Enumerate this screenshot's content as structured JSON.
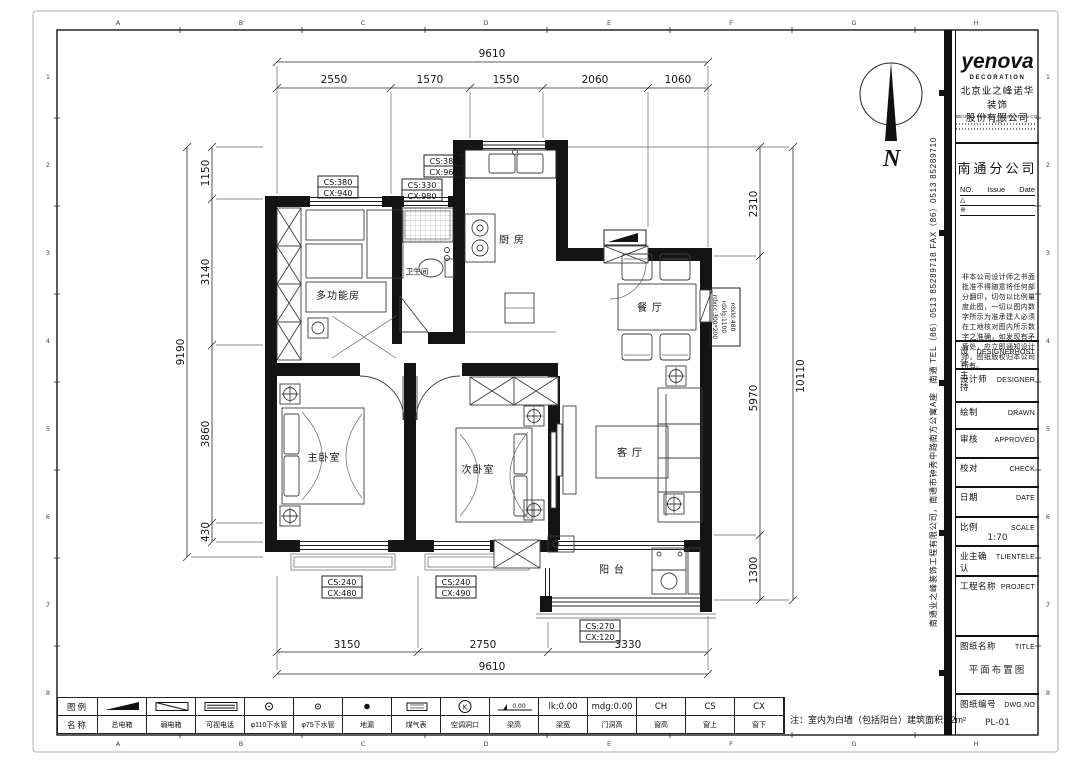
{
  "frame": {
    "letters": [
      "A",
      "B",
      "C",
      "D",
      "E",
      "F",
      "G",
      "H"
    ],
    "numbers": [
      "1",
      "2",
      "3",
      "4",
      "5",
      "6",
      "7",
      "8"
    ]
  },
  "compass": {
    "label": "N"
  },
  "plan": {
    "rooms": {
      "multi": "多功能房",
      "bath": "卫生间",
      "kitchen": "厨 房",
      "dining": "餐 厅",
      "master": "主卧室",
      "second": "次卧室",
      "living": "客 厅",
      "balcony": "阳 台"
    },
    "window_tags": [
      {
        "cs": "CS:380",
        "cx": "CX:940"
      },
      {
        "cs": "CS:330",
        "cx": "CX:980"
      },
      {
        "cs": "CS:380",
        "cx": "CX:960"
      },
      {
        "cs": "CS:240",
        "cx": "CX:480"
      },
      {
        "cs": "CS:240",
        "cx": "CX:490"
      },
      {
        "cs": "CS:270",
        "cx": "CX:120"
      }
    ],
    "beam_tag": {
      "l1": "rdxld:480",
      "l2": "rdxlg:1100",
      "l3": "rdxcc:300*200"
    },
    "dims": {
      "top": {
        "overall": "9610",
        "segs": [
          "2550",
          "1570",
          "1550",
          "2060",
          "1060"
        ]
      },
      "bottom": {
        "overall": "9610",
        "segs": [
          "3150",
          "2750",
          "3330"
        ]
      },
      "left": {
        "overall": "9190",
        "segs": [
          "1150",
          "3140",
          "3860",
          "430"
        ]
      },
      "right": {
        "overall": "10110",
        "segs": [
          "2310",
          "5970",
          "1300"
        ]
      }
    }
  },
  "legend": {
    "row1_header": "图例",
    "row2_header": "名称",
    "items": [
      {
        "name": "总电箱"
      },
      {
        "name": "弱电箱"
      },
      {
        "name": "可视电话"
      },
      {
        "name": "φ110下水管"
      },
      {
        "name": "φ75下水管"
      },
      {
        "name": "地漏"
      },
      {
        "name": "煤气表"
      },
      {
        "name": "空调洞口",
        "symbol_text": "K"
      },
      {
        "name": "梁高",
        "symbol_text": "0.00"
      },
      {
        "name": "梁宽",
        "symbol_text": "lk:0.00"
      },
      {
        "name": "门洞高",
        "symbol_text": "mdg:0.00"
      },
      {
        "name": "窗高",
        "symbol_text": "CH"
      },
      {
        "name": "窗上",
        "symbol_text": "CS"
      },
      {
        "name": "窗下",
        "symbol_text": "CX"
      }
    ],
    "note": "注：室内为白墙（包括阳台）建筑面积:82m²"
  },
  "titleblock": {
    "logo": "yenova",
    "logo_sub": "DECORATION",
    "company_cn1": "北京业之峰诺华装饰",
    "company_cn2": "股份有限公司",
    "company_en": "BEIJING YENOVA DECORATION CO. LTD",
    "branch": "南通分公司",
    "rev": {
      "no": "NO.",
      "issue": "Issue",
      "date": "Date",
      "r1": "△",
      "r2": "※"
    },
    "disclaimer": "非本公司设计师之书面批准不得随意将任何部分翻印，切勿以比例量度此图，一切以图内数字所示为准承建人必须在工地核对图内所示数字之准确，如发现有矛盾处，应立即通知设计师，图纸版权归本公司所有。",
    "rows": [
      {
        "cn": "设计主持",
        "en": "DESIGNERHOST"
      },
      {
        "cn": "设计师",
        "en": "DESIGNER"
      },
      {
        "cn": "绘制",
        "en": "DRAWN"
      },
      {
        "cn": "审核",
        "en": "APPROVED"
      },
      {
        "cn": "校对",
        "en": "CHECK"
      },
      {
        "cn": "日期",
        "en": "DATE"
      },
      {
        "cn": "比例",
        "en": "SCALE",
        "value": "1:70"
      },
      {
        "cn": "业主确认",
        "en": "TLIENTELE"
      },
      {
        "cn": "工程名称",
        "en": "PROJECT"
      },
      {
        "cn": "图纸名称",
        "en": "TITLE",
        "value": "平面布置图"
      },
      {
        "cn": "图纸编号",
        "en": "DWG.NO",
        "value": "PL-01"
      }
    ],
    "side_text": "南通业之峰装饰工程有限公司，南通市钟秀中路南方公寓A座　南通 TEL（86）0513 85289718 FAX（86）0513 85289710"
  }
}
